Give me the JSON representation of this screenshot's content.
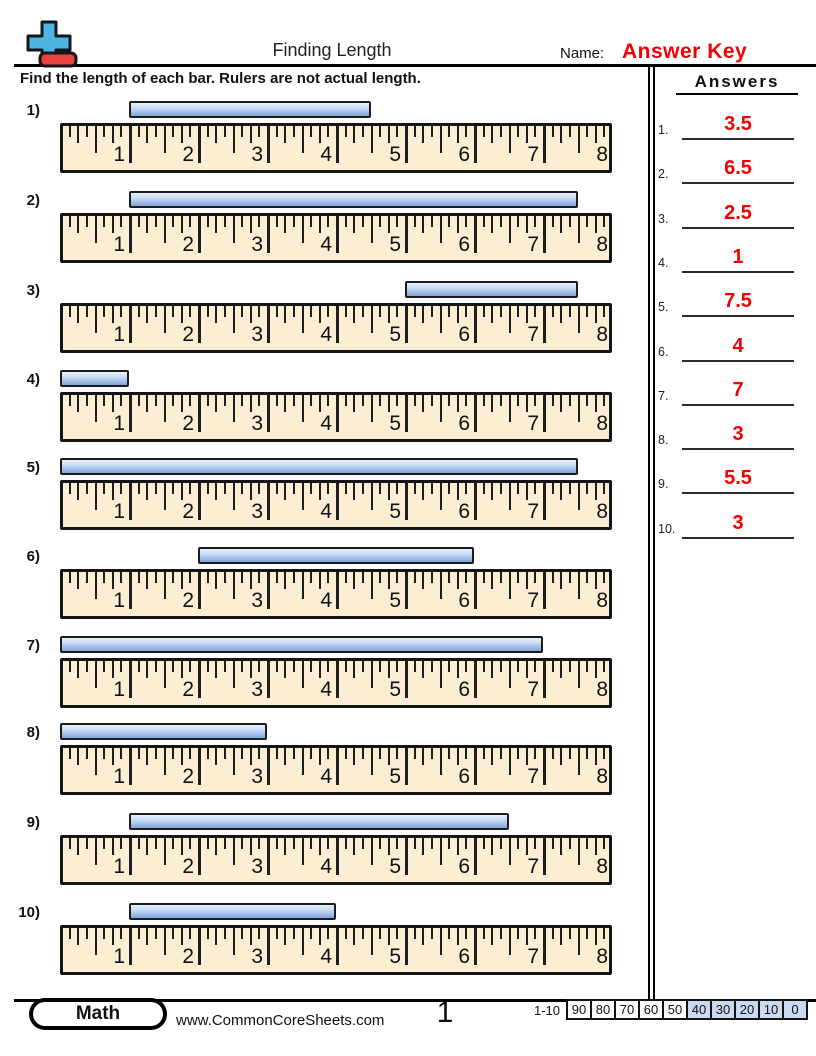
{
  "header": {
    "title": "Finding Length",
    "name_label": "Name:",
    "name_value": "Answer Key",
    "instruction": "Find the length of each bar. Rulers are not actual length."
  },
  "ruler": {
    "numbers": [
      "1",
      "2",
      "3",
      "4",
      "5",
      "6",
      "7",
      "8"
    ],
    "inches": 8,
    "subdivisions_per_inch": 8
  },
  "problems": [
    {
      "label": "1)",
      "bar_start": 1,
      "bar_end": 4.5,
      "length": 3.5
    },
    {
      "label": "2)",
      "bar_start": 1,
      "bar_end": 7.5,
      "length": 6.5
    },
    {
      "label": "3)",
      "bar_start": 5,
      "bar_end": 7.5,
      "length": 2.5
    },
    {
      "label": "4)",
      "bar_start": 0,
      "bar_end": 1,
      "length": 1
    },
    {
      "label": "5)",
      "bar_start": 0,
      "bar_end": 7.5,
      "length": 7.5
    },
    {
      "label": "6)",
      "bar_start": 2,
      "bar_end": 6,
      "length": 4
    },
    {
      "label": "7)",
      "bar_start": 0,
      "bar_end": 7,
      "length": 7
    },
    {
      "label": "8)",
      "bar_start": 0,
      "bar_end": 3,
      "length": 3
    },
    {
      "label": "9)",
      "bar_start": 1,
      "bar_end": 6.5,
      "length": 5.5
    },
    {
      "label": "10)",
      "bar_start": 1,
      "bar_end": 4,
      "length": 3
    }
  ],
  "answers": {
    "title": "Answers",
    "items": [
      {
        "num": "1.",
        "value": "3.5"
      },
      {
        "num": "2.",
        "value": "6.5"
      },
      {
        "num": "3.",
        "value": "2.5"
      },
      {
        "num": "4.",
        "value": "1"
      },
      {
        "num": "5.",
        "value": "7.5"
      },
      {
        "num": "6.",
        "value": "4"
      },
      {
        "num": "7.",
        "value": "7"
      },
      {
        "num": "8.",
        "value": "3"
      },
      {
        "num": "9.",
        "value": "5.5"
      },
      {
        "num": "10.",
        "value": "3"
      }
    ]
  },
  "footer": {
    "badge": "Math",
    "website": "www.CommonCoreSheets.com",
    "page_number": "1",
    "score_label": "1-10",
    "score_values": [
      "90",
      "80",
      "70",
      "60",
      "50",
      "40",
      "30",
      "20",
      "10",
      "0"
    ]
  },
  "colors": {
    "accent_red": "#f40000",
    "bar_blue_light": "#e9f0fb",
    "bar_blue_mid": "#c9dbf4",
    "bar_blue_dark": "#7fa5dc",
    "ruler_cream": "#fbeed3",
    "score_box_blue": "#c9daf0",
    "logo_blue": "#4db4e4",
    "logo_red": "#e8433c"
  }
}
